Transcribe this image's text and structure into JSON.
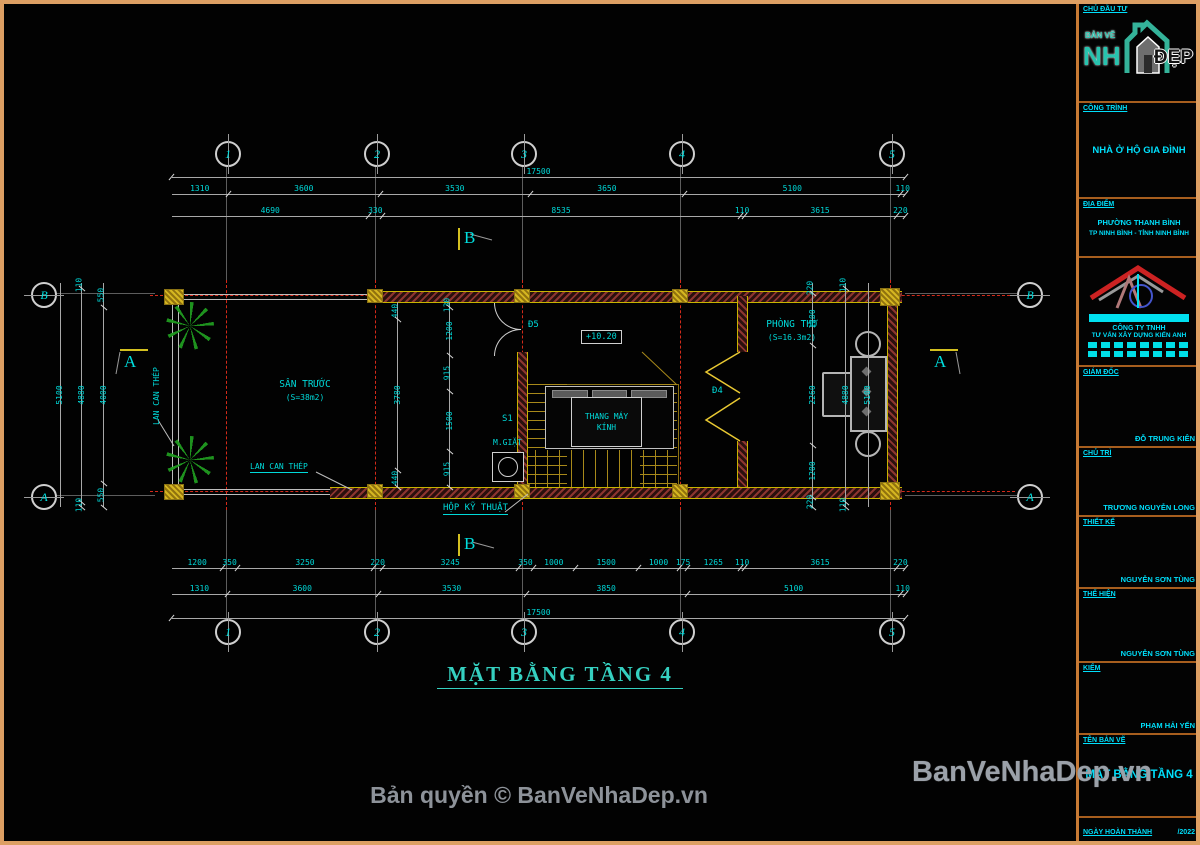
{
  "colors": {
    "accent_cyan": "#00d9d9",
    "frame_orange": "#dd9f63",
    "wall_yellow": "#c8b400",
    "hatch_red": "#8c3530",
    "centerline_red": "#d42a1a",
    "tree_green": "#1f9a1f",
    "title_teal": "#35d0c0",
    "watermark_gray": "#9ba1a9"
  },
  "grid": {
    "cols": [
      "1",
      "2",
      "3",
      "4",
      "5"
    ],
    "rowB": "B",
    "rowA": "A"
  },
  "dims": {
    "top": {
      "total": "17500",
      "row2": [
        "1310",
        "3600",
        "3530",
        "3650",
        "5100",
        "110"
      ],
      "row3": [
        "4690",
        "330",
        "8535",
        "110",
        "3615",
        "220"
      ]
    },
    "bottom": {
      "row1": [
        "1200",
        "350",
        "3250",
        "220",
        "3245",
        "350",
        "1000",
        "1500",
        "1000",
        "175",
        "1265",
        "110",
        "3615",
        "220"
      ],
      "row2": [
        "1310",
        "3600",
        "3530",
        "3850",
        "5100",
        "110"
      ],
      "total": "17500"
    },
    "left": {
      "outer": "5100",
      "mid": [
        "110",
        "4880",
        "110"
      ],
      "chain": [
        "550",
        "4000",
        "550"
      ]
    },
    "right": {
      "outer": "5100",
      "mid": [
        "110",
        "4880",
        "110"
      ],
      "chain": [
        "220",
        "1200",
        "2260",
        "1200",
        "220"
      ]
    },
    "corridor": {
      "chain_a": [
        "440",
        "3780",
        "440"
      ],
      "chain_b": [
        "130",
        "1200",
        "915",
        "1500",
        "915"
      ]
    }
  },
  "rooms": {
    "san_truoc": {
      "name": "SÂN TRƯỚC",
      "area": "(S=38m2)"
    },
    "phong_tho": {
      "name": "PHÒNG THỜ",
      "area": "(S=16.3m2)"
    },
    "elevator": {
      "line1": "THANG MÁY",
      "line2": "KÍNH"
    }
  },
  "labels": {
    "d5": "Đ5",
    "d4": "Đ4",
    "s1": "S1",
    "m_giat": "M.GIẶT",
    "hop_ky_thuat": "HỘP KỸ THUẬT",
    "lan_can_thep": "LAN CAN THÉP",
    "elevation": "+10.20",
    "section_a": "A",
    "section_b": "B"
  },
  "title": {
    "text": "MẶT BẰNG TẦNG 4"
  },
  "footer": {
    "copyright": "Bản quyền © BanVeNhaDep.vn"
  },
  "watermark": {
    "text": "BanVeNhaDep.vn"
  },
  "sidebar": {
    "s1_label": "CHỦ ĐẦU TƯ",
    "logo": {
      "banve": "BẢN VẼ",
      "nh": "NH",
      "dep": "ĐẸP"
    },
    "s2_label": "CÔNG TRÌNH",
    "s2_value": "NHÀ Ở HỘ GIA ĐÌNH",
    "s3_label": "ĐỊA ĐIỂM",
    "s3_line1": "PHƯỜNG THANH BÌNH",
    "s3_line2": "TP NINH BÌNH - TỈNH NINH BÌNH",
    "s4_line1": "CÔNG TY TNHH",
    "s4_line2": "TƯ VẤN XÂY DỰNG KIẾN ANH",
    "s5_label": "GIÁM ĐỐC",
    "s5_value": "ĐỖ TRUNG KIÊN",
    "s6_label": "CHỦ TRÌ",
    "s6_value": "TRƯƠNG NGUYỄN LONG",
    "s7_label": "THIẾT KẾ",
    "s7_value": "NGUYỄN SƠN TÙNG",
    "s8_label": "THỂ HIỆN",
    "s8_value": "NGUYỄN SƠN TÙNG",
    "s9_label": "KIỂM",
    "s9_value": "PHẠM HẢI YẾN",
    "s10_label": "TÊN BẢN VẼ",
    "s10_value": "MẶT BẰNG TẦNG 4",
    "s11_label": "NGÀY HOÀN THÀNH",
    "s11_value": "/2022",
    "s12_label": "TỶ LỆ",
    "s13_label": "BẢN VẼ",
    "s13_value": "KT-04"
  }
}
